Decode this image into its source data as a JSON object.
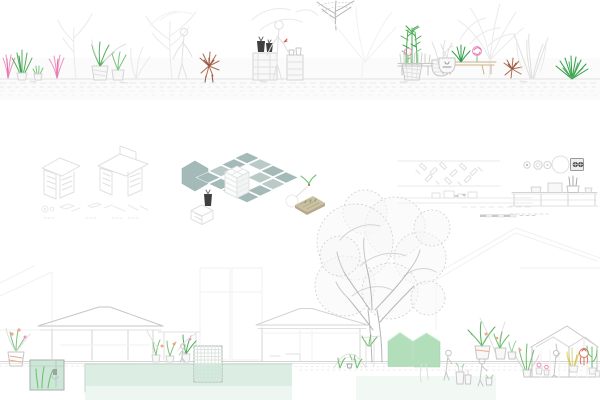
{
  "board": {
    "kind": "architectural-presentation-board",
    "visible_text": [],
    "strips": [
      "plant-elevation",
      "axonometric-diagrams",
      "building-section"
    ]
  },
  "colors": {
    "paper": "#ffffff",
    "sage_tile": "#a4bab8",
    "sage_tile_light": "#b9cac7",
    "pot_dark": "#3f3f3f",
    "wood_tan": "#cbc1a4",
    "wood_tan_side": "#b5aa8b",
    "mint_pool": "#cde6d8",
    "mint_pool_pale": "#dcede4",
    "mint_pool_fade": "#eef6f1",
    "mint_wash": "#f2f8f4",
    "shed_green": "#b2deba",
    "cube_white": "#fdfdfe",
    "legend_knob": "#4a4a4a",
    "sketch_gray": "#c6c6c6",
    "plant_green": "#4fae57",
    "plant_green_soft": "#7cc47c",
    "flower_pink": "#ee93c0",
    "flower_magenta": "#e36bab",
    "plant_rust": "#b06a4e",
    "flower_peach": "#f0a98c",
    "greenhouse_yellow": "#ddd46e",
    "greenhouse_red": "#dd7466",
    "greenhouse_green": "#6abf69",
    "table_tan": "#cdb38a"
  },
  "components": {
    "top_elevation": [
      "pink-fan-plant",
      "green-fan-plant",
      "potted-green-plants",
      "faint-trees",
      "rust-dry-plant",
      "plant-shelf-with-dark-pots",
      "sketched-figure",
      "bamboo-in-basket",
      "faint-palm",
      "tan-table-with-agave-and-pink-bloom",
      "planter-bench-with-pink-bloom",
      "sketch-pot",
      "tall-sketched-grasses",
      "green-yucca",
      "hatched-ground"
    ],
    "middle_diagrams": [
      "iso-cabinet-a",
      "iso-cabinet-b",
      "exploded-parts-row",
      "sage-hexagon",
      "dark-pot-icon",
      "ghost-cube",
      "sage-tile-plan",
      "lattice-cube",
      "ghost-circle",
      "sprout-icon",
      "tan-seed-tray",
      "paving-pattern-strip",
      "mini-elevation-strip",
      "scale-bar",
      "burner-circles",
      "control-square",
      "counter-elevation"
    ],
    "bottom_section": [
      "background-roof-lines",
      "pavilion-left",
      "pavilion-middle",
      "big-sketch-tree",
      "peach-potted-plant",
      "planted-water-tank",
      "large-mint-pool",
      "lattice-water-tank",
      "ground-plants",
      "sketched-figures",
      "garden-arch",
      "vine-post",
      "green-sheds",
      "potted-plant-group",
      "greenhouse-with-plants",
      "ground-line"
    ]
  }
}
